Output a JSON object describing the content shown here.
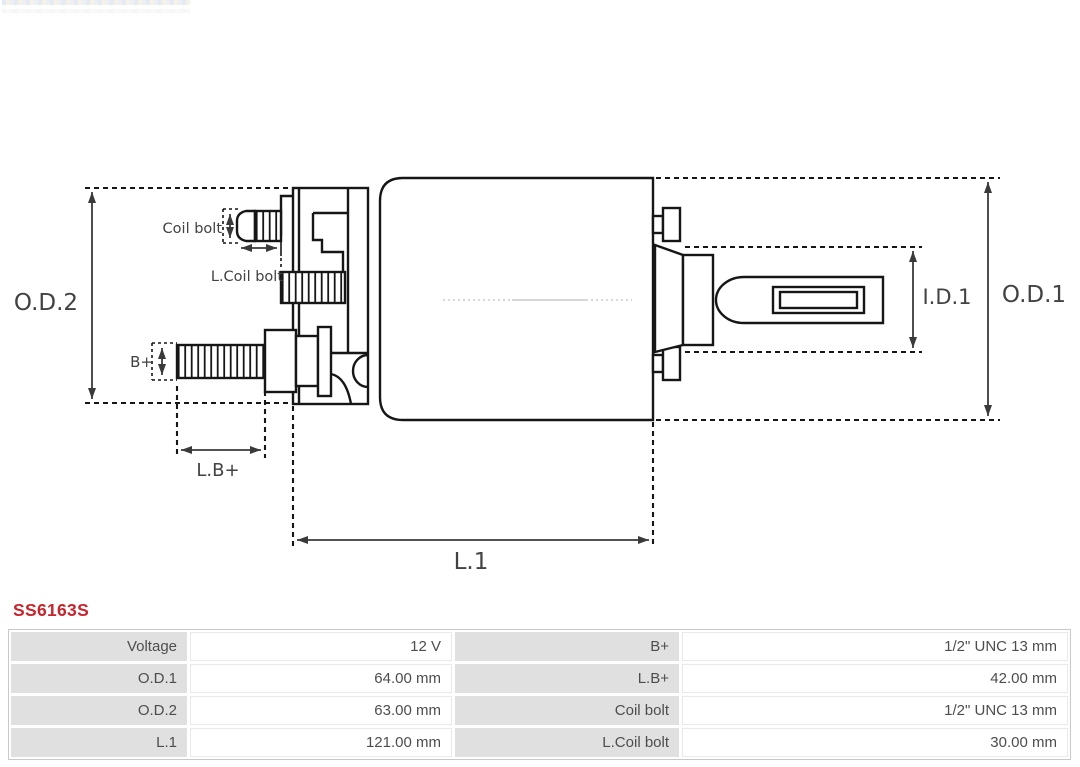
{
  "product": {
    "code": "SS6163S",
    "code_color": "#c9242b"
  },
  "diagram": {
    "type": "starter-solenoid-dimension-drawing",
    "labels": {
      "od2": "O.D.2",
      "od1": "O.D.1",
      "id1": "I.D.1",
      "l1": "L.1",
      "lbplus": "L.B+",
      "bplus": "B+",
      "coil_bolt": "Coil bolt",
      "l_coil_bolt": "L.Coil bolt"
    }
  },
  "table": {
    "rows": [
      {
        "c0": "Voltage",
        "c1": "12 V",
        "c2": "B+",
        "c3": "1/2\" UNC 13 mm"
      },
      {
        "c0": "O.D.1",
        "c1": "64.00 mm",
        "c2": "L.B+",
        "c3": "42.00 mm"
      },
      {
        "c0": "O.D.2",
        "c1": "63.00 mm",
        "c2": "Coil bolt",
        "c3": "1/2\" UNC 13 mm"
      },
      {
        "c0": "L.1",
        "c1": "121.00 mm",
        "c2": "L.Coil bolt",
        "c3": "30.00 mm"
      }
    ]
  }
}
